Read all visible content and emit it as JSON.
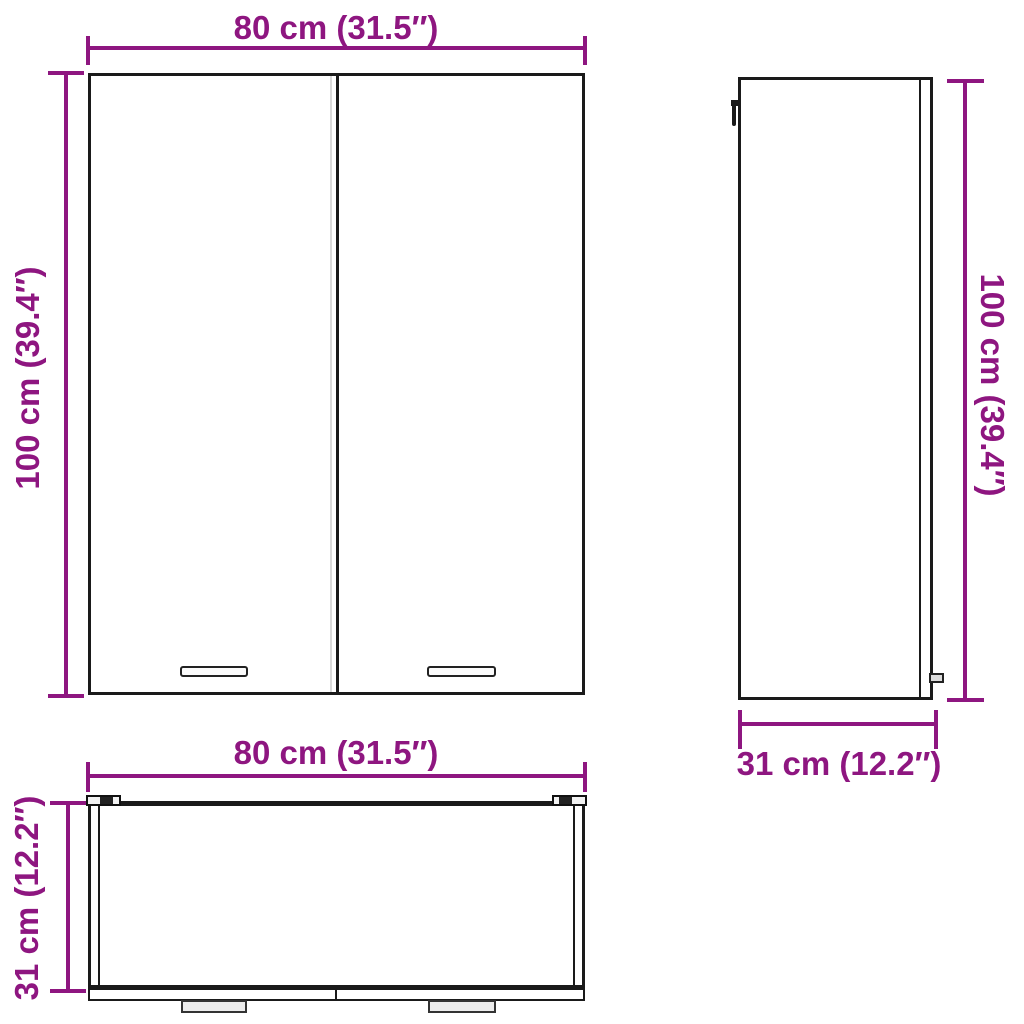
{
  "title": "Wall cabinet dimension diagram",
  "colors": {
    "accent": "#8E1680",
    "line": "#1a1a1a",
    "bg": "#ffffff"
  },
  "dimensions": {
    "width_cm": "80",
    "height_cm": "100",
    "depth_cm": "31",
    "width_label": "80 cm (31.5″)",
    "height_label": "100 cm (39.4″)",
    "depth_label": "31 cm (12.2″)"
  },
  "views": {
    "front": {
      "width_label": "80 cm (31.5″)",
      "height_label": "100 cm (39.4″)"
    },
    "side": {
      "height_label": "100 cm (39.4″)",
      "depth_label": "31 cm (12.2″)"
    },
    "top": {
      "width_label": "80 cm (31.5″)",
      "depth_label": "31 cm (12.2″)"
    }
  }
}
